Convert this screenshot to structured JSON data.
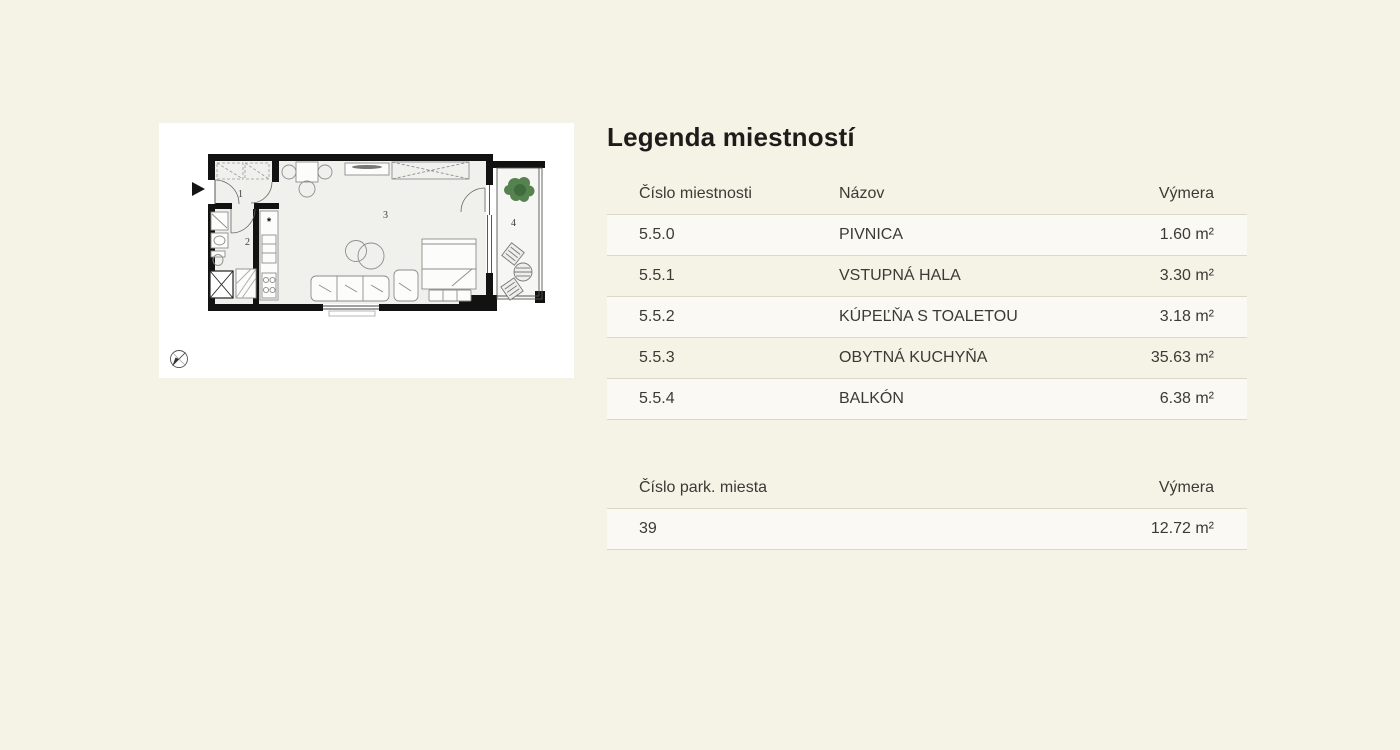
{
  "colors": {
    "background": "#f5f2e6",
    "row_stripe": "#faf8f0",
    "divider": "#dcd8c8",
    "text": "#3b3a36",
    "title_text": "#1d1c1a",
    "wall_black": "#121212",
    "plant_green": "#55824f"
  },
  "floorplan": {
    "room_numbers": [
      "1",
      "2",
      "3",
      "4"
    ],
    "kitchen_symbol": "*"
  },
  "legend": {
    "title": "Legenda miestností",
    "rooms_table": {
      "headers": {
        "number": "Číslo miestnosti",
        "name": "Názov",
        "area": "Výmera"
      },
      "rows": [
        {
          "number": "5.5.0",
          "name": "PIVNICA",
          "area": "1.60 m²"
        },
        {
          "number": "5.5.1",
          "name": "VSTUPNÁ HALA",
          "area": "3.30 m²"
        },
        {
          "number": "5.5.2",
          "name": "KÚPEĽŇA S TOALETOU",
          "area": "3.18 m²"
        },
        {
          "number": "5.5.3",
          "name": "OBYTNÁ KUCHYŇA",
          "area": "35.63 m²"
        },
        {
          "number": "5.5.4",
          "name": "BALKÓN",
          "area": "6.38 m²"
        }
      ]
    },
    "parking_table": {
      "headers": {
        "number": "Číslo park. miesta",
        "area": "Výmera"
      },
      "rows": [
        {
          "number": "39",
          "area": "12.72 m²"
        }
      ]
    }
  }
}
